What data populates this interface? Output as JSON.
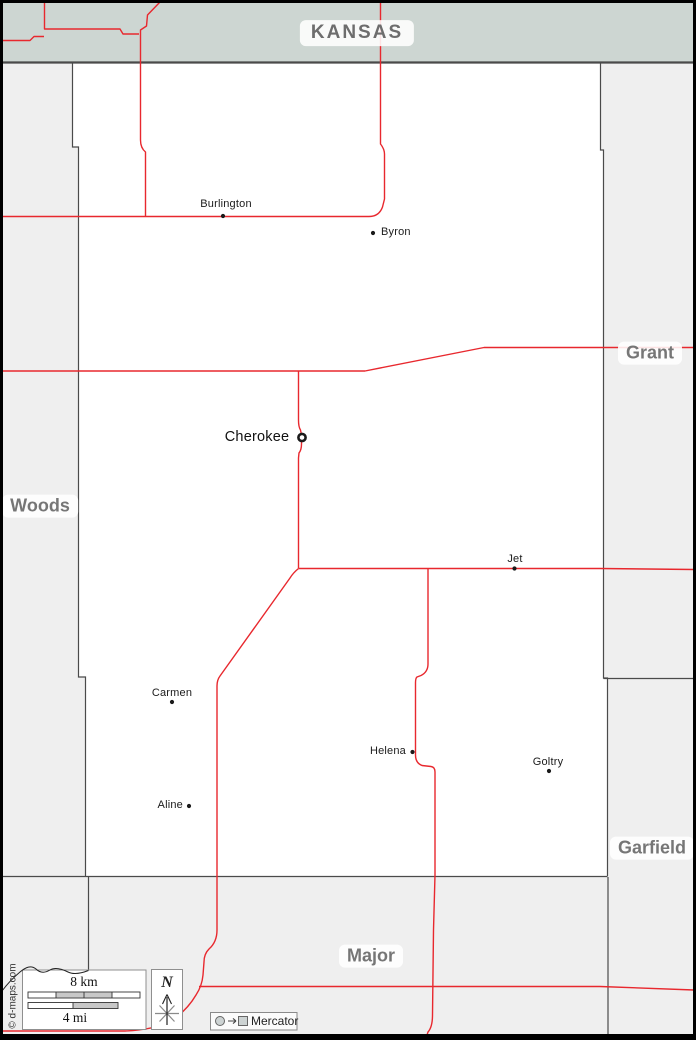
{
  "title_band": {
    "label": "KANSAS"
  },
  "neighbor_counties": {
    "west": "Woods",
    "east": "Grant",
    "southeast": "Garfield",
    "south": "Major"
  },
  "towns": {
    "burlington": "Burlington",
    "byron": "Byron",
    "cherokee": "Cherokee",
    "jet": "Jet",
    "carmen": "Carmen",
    "helena": "Helena",
    "goltry": "Goltry",
    "aline": "Aline"
  },
  "legend": {
    "scale_km": "8 km",
    "scale_mi": "4 mi",
    "north": "N",
    "projection": "Mercator",
    "credit": "© d-maps.com"
  },
  "colors": {
    "road_red": "#e8282e",
    "state_band_fill": "#cdd6d2",
    "neighbor_fill": "#efefef",
    "county_fill": "#ffffff",
    "border_gray": "#4a4a4a",
    "label_gray": "#767676"
  }
}
